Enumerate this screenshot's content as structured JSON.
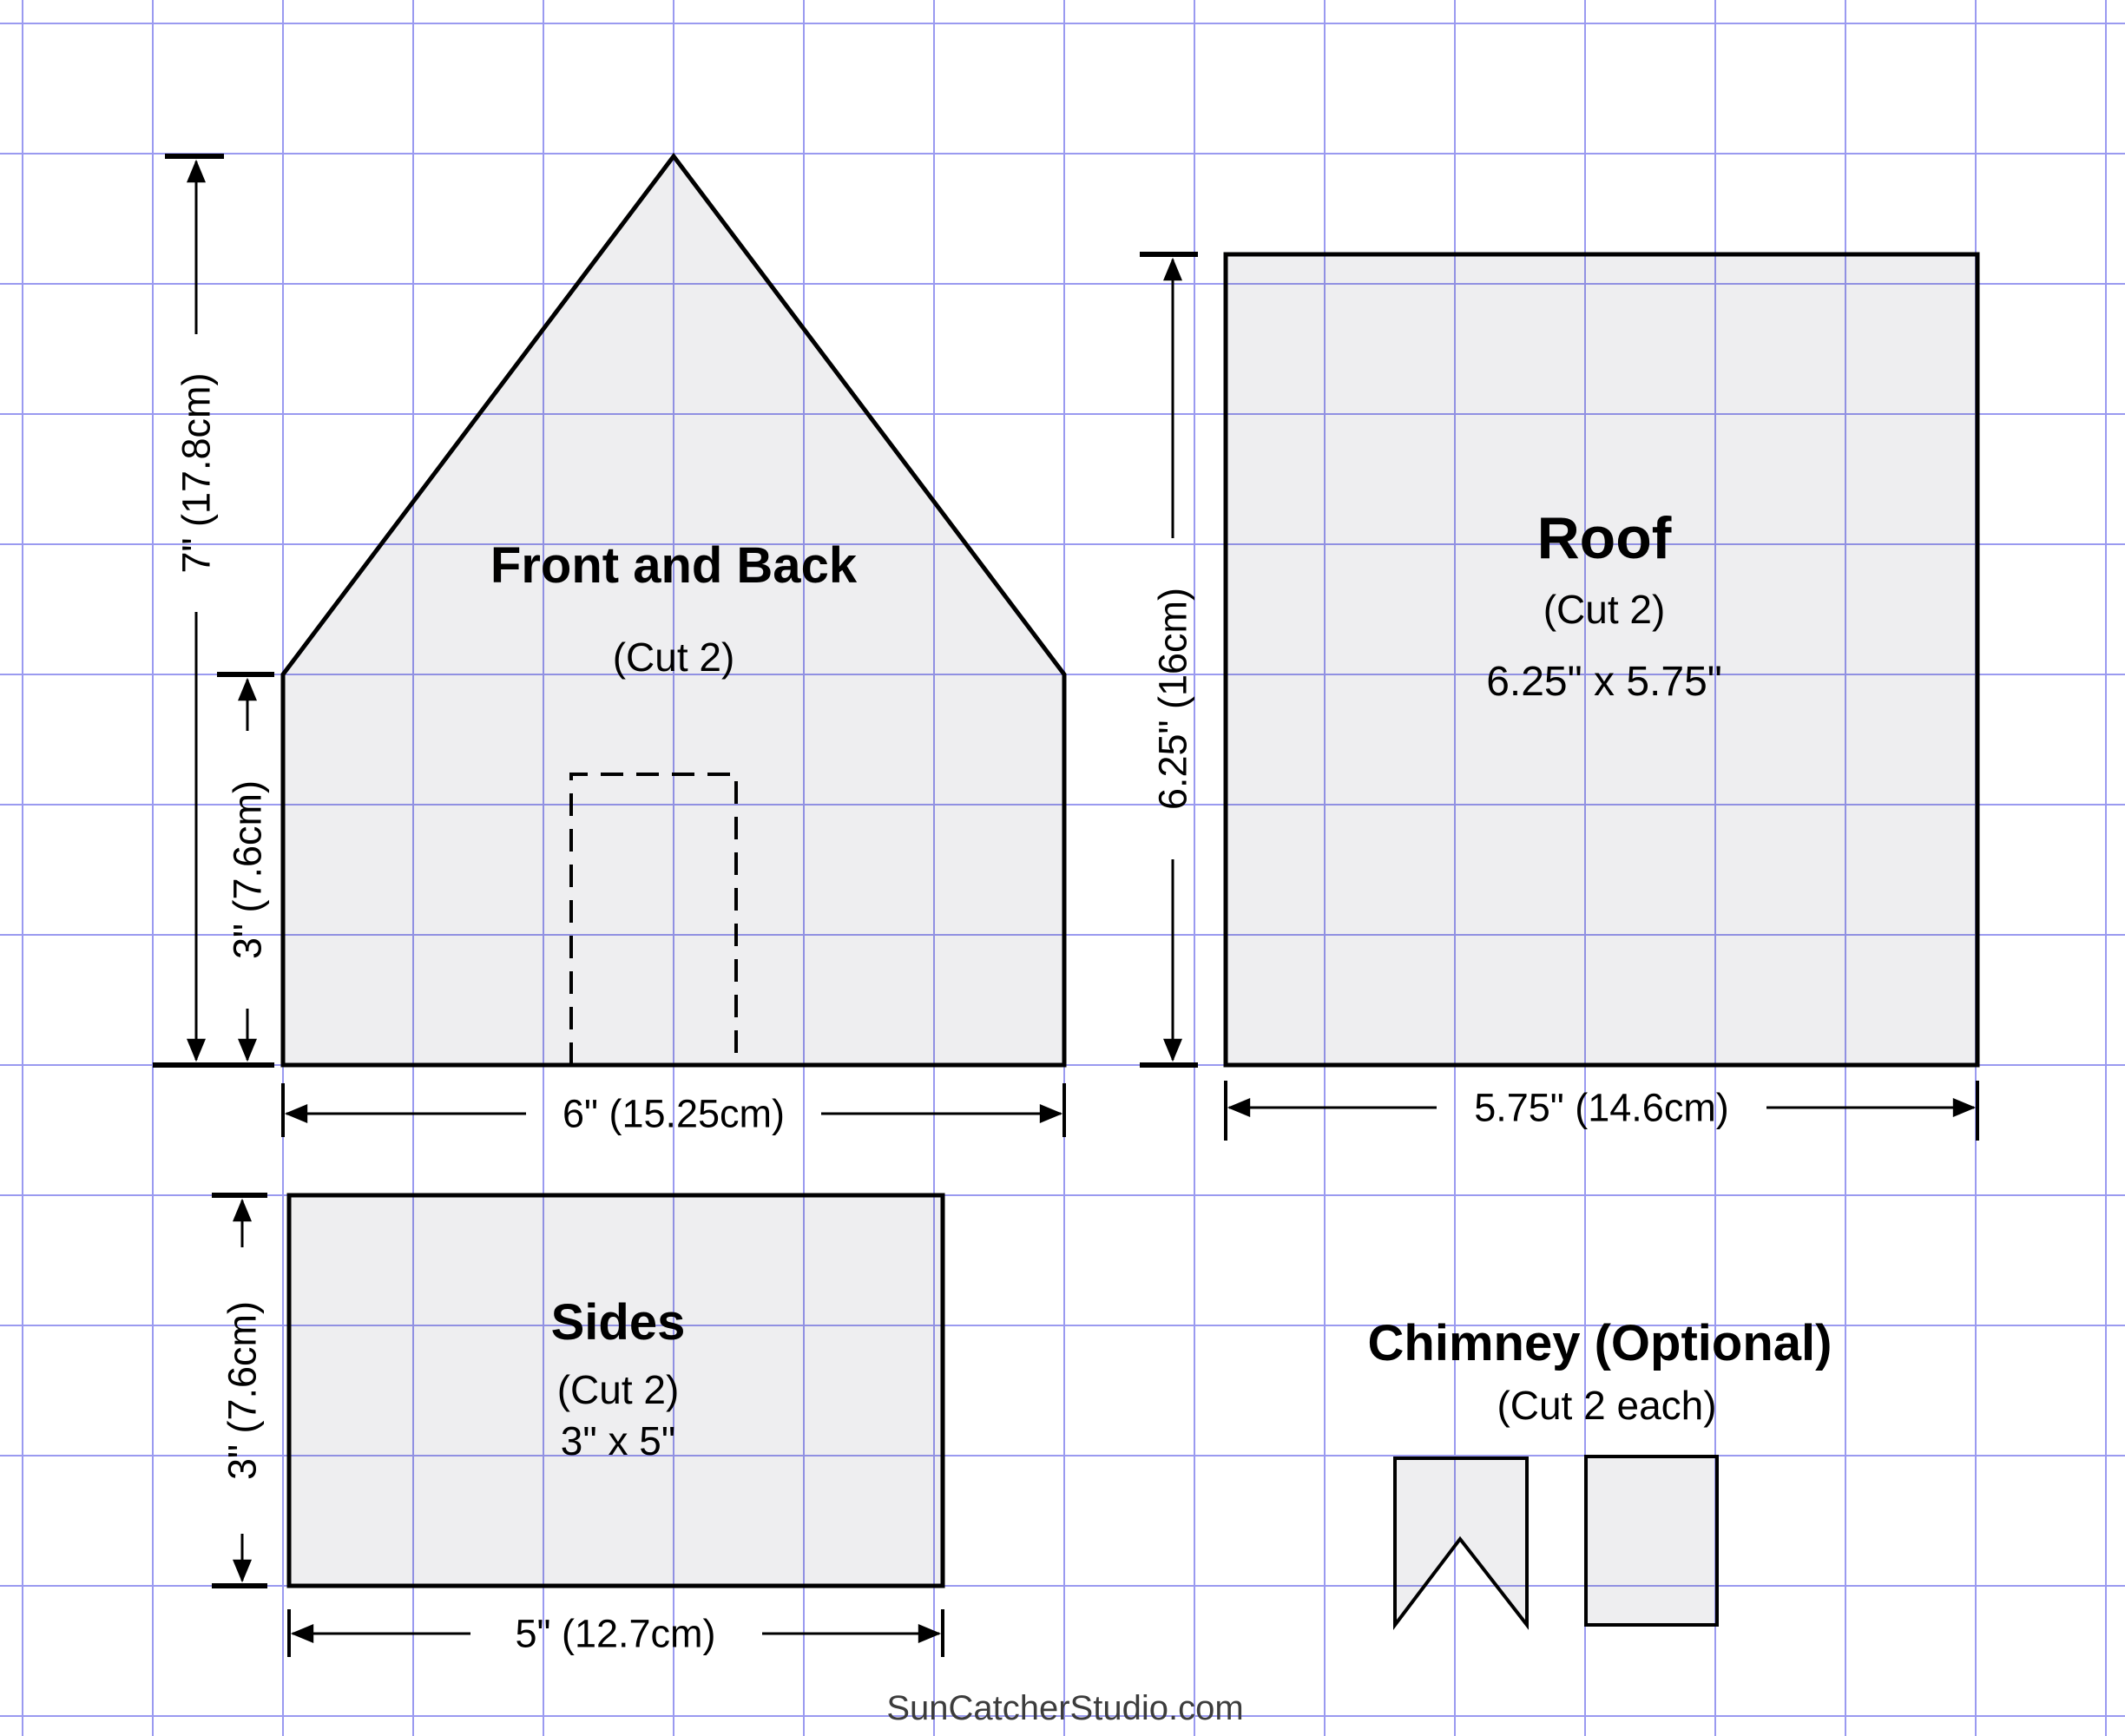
{
  "colors": {
    "grid_line": "#9a9af0",
    "piece_fill": "rgba(20,20,40,0.07)",
    "outline": "#000000",
    "dimension": "#000000",
    "watermark_text": "#3c3c3c"
  },
  "grid": {
    "spacing": "150px",
    "ox": "25px",
    "oy": "26px"
  },
  "pieces": {
    "front_back": {
      "title": "Front and Back",
      "cut": "(Cut 2)"
    },
    "roof": {
      "title": "Roof",
      "cut": "(Cut 2)",
      "size": "6.25\" x 5.75\""
    },
    "sides": {
      "title": "Sides",
      "cut": "(Cut 2)",
      "size": "3\" x 5\""
    },
    "chimney": {
      "title": "Chimney (Optional)",
      "cut": "(Cut 2 each)"
    }
  },
  "dimensions": {
    "front_total_height": "7\" (17.8cm)",
    "front_wall_height": "3\" (7.6cm)",
    "front_width": "6\" (15.25cm)",
    "roof_length": "6.25\" (16cm)",
    "roof_width": "5.75\" (14.6cm)",
    "sides_height": "3\" (7.6cm)",
    "sides_width": "5\" (12.7cm)"
  },
  "watermark": "SunCatcherStudio.com"
}
